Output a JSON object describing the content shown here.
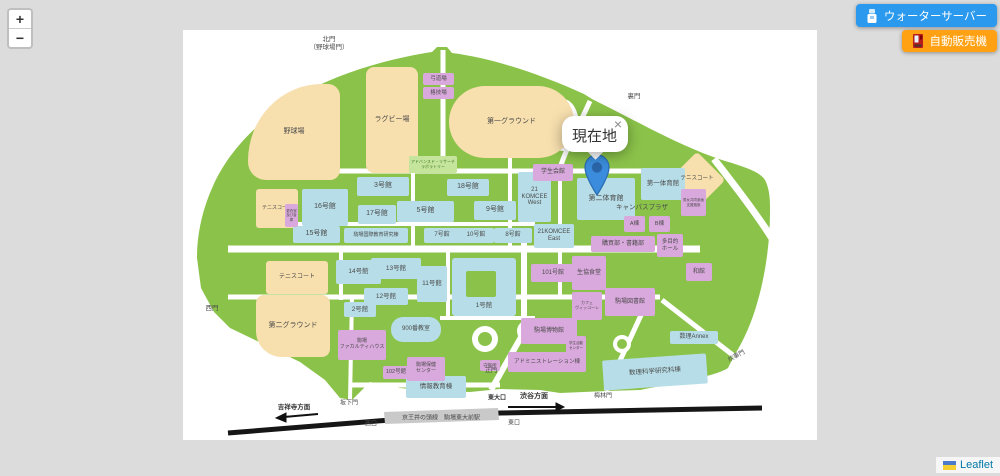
{
  "ui": {
    "zoom_in": "+",
    "zoom_out": "−",
    "buttons": {
      "water": {
        "label": "ウォーターサーバー",
        "color": "#2B99EE"
      },
      "vending": {
        "label": "自動販売機",
        "color": "#FFA113"
      }
    },
    "popup": {
      "text": "現在地",
      "close": "×"
    },
    "attribution": {
      "label": "Leaflet"
    }
  },
  "map": {
    "colors": {
      "campus_green": "#8BC34A",
      "building_blue": "#B7DEE8",
      "building_pink": "#D9A8DC",
      "field_tan": "#F7DFAE",
      "road_white": "#ffffff",
      "railway_black": "#161616",
      "marker_blue": "#3B8CDC"
    },
    "shapes": [
      {
        "label": "野球場",
        "kind": "tan",
        "x": 248,
        "y": 84,
        "w": 92,
        "h": 96,
        "br": "80% 12px 10px 18px",
        "fs": 7
      },
      {
        "label": "ラグビー場",
        "kind": "tan",
        "x": 366,
        "y": 67,
        "w": 52,
        "h": 106,
        "br": "8px",
        "fs": 7
      },
      {
        "label": "第一グラウンド",
        "kind": "tan",
        "x": 449,
        "y": 86,
        "w": 125,
        "h": 72,
        "br": "36px",
        "fs": 7
      },
      {
        "label": "",
        "kind": "tan",
        "x": 677,
        "y": 160,
        "w": 40,
        "h": 40,
        "rot": 45,
        "br": "4px"
      },
      {
        "label": "テニスコート",
        "kind": "tan",
        "x": 256,
        "y": 189,
        "w": 42,
        "h": 39,
        "fs": 5,
        "br": "3px"
      },
      {
        "label": "テニスコート",
        "kind": "tan",
        "x": 266,
        "y": 261,
        "w": 62,
        "h": 33,
        "fs": 6,
        "br": "3px"
      },
      {
        "label": "第二グラウンド",
        "kind": "tan",
        "x": 256,
        "y": 295,
        "w": 74,
        "h": 62,
        "br": "8px 8px 8px 26px",
        "fs": 7
      },
      {
        "label": "3号館",
        "kind": "blue",
        "x": 357,
        "y": 177,
        "w": 52,
        "h": 19,
        "fs": 7
      },
      {
        "label": "16号館",
        "kind": "blue",
        "x": 302,
        "y": 189,
        "w": 46,
        "h": 37,
        "fs": 7
      },
      {
        "label": "17号館",
        "kind": "blue",
        "x": 358,
        "y": 205,
        "w": 38,
        "h": 19,
        "fs": 7
      },
      {
        "label": "5号館",
        "kind": "blue",
        "x": 397,
        "y": 201,
        "w": 57,
        "h": 21,
        "fs": 7
      },
      {
        "label": "18号館",
        "kind": "blue",
        "x": 447,
        "y": 179,
        "w": 42,
        "h": 17,
        "fs": 7
      },
      {
        "label": "9号館",
        "kind": "blue",
        "x": 474,
        "y": 201,
        "w": 42,
        "h": 19,
        "fs": 7
      },
      {
        "label": "15号館",
        "kind": "blue",
        "x": 293,
        "y": 226,
        "w": 47,
        "h": 17,
        "fs": 7
      },
      {
        "label": "駒場国際教育研究棟",
        "kind": "blue",
        "x": 344,
        "y": 228,
        "w": 64,
        "h": 15,
        "fs": 5
      },
      {
        "label": "7号館",
        "kind": "blue",
        "x": 424,
        "y": 228,
        "w": 36,
        "h": 15,
        "fs": 6
      },
      {
        "label": "10号館",
        "kind": "blue",
        "x": 458,
        "y": 228,
        "w": 36,
        "h": 15,
        "fs": 6
      },
      {
        "label": "8号館",
        "kind": "blue",
        "x": 494,
        "y": 228,
        "w": 38,
        "h": 15,
        "fs": 6
      },
      {
        "label": "21\nKOMCEE\nWest",
        "kind": "blue",
        "x": 518,
        "y": 172,
        "w": 33,
        "h": 50,
        "fs": 6
      },
      {
        "label": "21KOMCEE\nEast",
        "kind": "blue",
        "x": 534,
        "y": 224,
        "w": 40,
        "h": 24,
        "fs": 6
      },
      {
        "label": "第二体育館",
        "kind": "blue",
        "x": 577,
        "y": 178,
        "w": 58,
        "h": 42,
        "fs": 7
      },
      {
        "label": "第一体育館",
        "kind": "blue",
        "x": 641,
        "y": 168,
        "w": 44,
        "h": 32,
        "fs": 6.5
      },
      {
        "label": "14号館",
        "kind": "blue",
        "x": 336,
        "y": 260,
        "w": 45,
        "h": 24,
        "fs": 6.5
      },
      {
        "label": "13号館",
        "kind": "blue",
        "x": 371,
        "y": 258,
        "w": 50,
        "h": 21,
        "fs": 6.5
      },
      {
        "label": "11号館",
        "kind": "blue",
        "x": 417,
        "y": 266,
        "w": 30,
        "h": 36,
        "fs": 6.5
      },
      {
        "label": "12号館",
        "kind": "blue",
        "x": 364,
        "y": 288,
        "w": 44,
        "h": 17,
        "fs": 6.5
      },
      {
        "label": "2号館",
        "kind": "blue",
        "x": 344,
        "y": 302,
        "w": 32,
        "h": 15,
        "fs": 6.5
      },
      {
        "label": "",
        "kind": "blue",
        "x": 452,
        "y": 258,
        "w": 64,
        "h": 58,
        "br": "3px"
      },
      {
        "label": "",
        "kind": "green",
        "x": 466,
        "y": 271,
        "w": 30,
        "h": 26
      },
      {
        "label": "900番教室",
        "kind": "blue",
        "x": 391,
        "y": 317,
        "w": 50,
        "h": 25,
        "br": "12px",
        "fs": 6
      },
      {
        "label": "情報教育棟",
        "kind": "blue",
        "x": 406,
        "y": 376,
        "w": 60,
        "h": 22,
        "fs": 6.5
      },
      {
        "label": "数理Annex",
        "kind": "blue",
        "x": 670,
        "y": 331,
        "w": 48,
        "h": 13,
        "fs": 6
      },
      {
        "label": "数理科学研究科棟",
        "kind": "blue",
        "x": 603,
        "y": 357,
        "w": 104,
        "h": 30,
        "rot": -4,
        "fs": 6.5
      },
      {
        "label": "弓道場",
        "kind": "pink",
        "x": 423,
        "y": 73,
        "w": 31,
        "h": 12,
        "fs": 5.5
      },
      {
        "label": "格技場",
        "kind": "pink",
        "x": 423,
        "y": 87,
        "w": 31,
        "h": 12,
        "fs": 5.5
      },
      {
        "label": "学生会館",
        "kind": "pink",
        "x": 533,
        "y": 164,
        "w": 40,
        "h": 17,
        "fs": 6
      },
      {
        "label": "A棟",
        "kind": "pink",
        "x": 624,
        "y": 216,
        "w": 21,
        "h": 16,
        "fs": 5.5
      },
      {
        "label": "B棟",
        "kind": "pink",
        "x": 649,
        "y": 216,
        "w": 21,
        "h": 16,
        "fs": 5.5
      },
      {
        "label": "購買部・書籍部",
        "kind": "pink",
        "x": 591,
        "y": 236,
        "w": 64,
        "h": 16,
        "fs": 6
      },
      {
        "label": "多目的\nホール",
        "kind": "pink",
        "x": 657,
        "y": 234,
        "w": 26,
        "h": 23,
        "fs": 5.5
      },
      {
        "label": "101号館",
        "kind": "pink",
        "x": 531,
        "y": 264,
        "w": 44,
        "h": 18,
        "fs": 6
      },
      {
        "label": "生協食堂",
        "kind": "pink",
        "x": 572,
        "y": 256,
        "w": 34,
        "h": 34,
        "fs": 6
      },
      {
        "label": "和館",
        "kind": "pink",
        "x": 686,
        "y": 263,
        "w": 26,
        "h": 18,
        "fs": 6
      },
      {
        "label": "駒場図書館",
        "kind": "pink",
        "x": 605,
        "y": 288,
        "w": 50,
        "h": 28,
        "fs": 6
      },
      {
        "label": "カフェ\nヴィッコーレ",
        "kind": "pink",
        "x": 572,
        "y": 292,
        "w": 30,
        "h": 28,
        "fs": 4
      },
      {
        "label": "駒場博物館",
        "kind": "pink",
        "x": 521,
        "y": 318,
        "w": 56,
        "h": 26,
        "fs": 6
      },
      {
        "label": "アドミニストレーション棟",
        "kind": "pink",
        "x": 508,
        "y": 352,
        "w": 78,
        "h": 20,
        "fs": 5.5
      },
      {
        "label": "学生活動\nセンター",
        "kind": "pink",
        "x": 566,
        "y": 336,
        "w": 20,
        "h": 19,
        "fs": 3.5
      },
      {
        "label": "駒場\nファカルティハウス",
        "kind": "pink",
        "x": 338,
        "y": 330,
        "w": 48,
        "h": 30,
        "fs": 5
      },
      {
        "label": "102号館",
        "kind": "pink",
        "x": 383,
        "y": 366,
        "w": 26,
        "h": 13,
        "fs": 5.5
      },
      {
        "label": "駒場保健\nセンター",
        "kind": "pink",
        "x": 407,
        "y": 357,
        "w": 38,
        "h": 24,
        "fs": 5
      },
      {
        "label": "守衛所",
        "kind": "pink",
        "x": 480,
        "y": 360,
        "w": 20,
        "h": 11,
        "fs": 4.5
      },
      {
        "label": "更衣室\n及び倉庫",
        "kind": "pink",
        "x": 285,
        "y": 204,
        "w": 13,
        "h": 23,
        "fs": 3.5
      },
      {
        "label": "男女共同参画\n支援施設",
        "kind": "pink",
        "x": 681,
        "y": 189,
        "w": 25,
        "h": 27,
        "fs": 3.5
      },
      {
        "label": "アドバンスド・リサーチ\nラボラトリー",
        "kind": "greenbox",
        "x": 409,
        "y": 156,
        "w": 48,
        "h": 17,
        "fs": 4
      }
    ],
    "texts": [
      {
        "label": "北門\n（野球場門）",
        "x": 329,
        "y": 44,
        "fs": 6.5
      },
      {
        "label": "裏門",
        "x": 634,
        "y": 97,
        "fs": 6.5
      },
      {
        "label": "西門",
        "x": 212,
        "y": 309,
        "fs": 6.5
      },
      {
        "label": "坂下門",
        "x": 349,
        "y": 404,
        "fs": 6
      },
      {
        "label": "正門",
        "x": 491,
        "y": 372,
        "fs": 6
      },
      {
        "label": "東大口",
        "x": 497,
        "y": 399,
        "fs": 6,
        "bold": true
      },
      {
        "label": "渋谷方面",
        "x": 534,
        "y": 397,
        "fs": 7,
        "bold": true
      },
      {
        "label": "東口",
        "x": 514,
        "y": 424,
        "fs": 6
      },
      {
        "label": "西口",
        "x": 371,
        "y": 425,
        "fs": 6
      },
      {
        "label": "京王井の頭線　駒場東大前駅",
        "x": 441,
        "y": 419,
        "fs": 6
      },
      {
        "label": "吉祥寺方面",
        "x": 294,
        "y": 408,
        "fs": 6.5,
        "bold": true
      },
      {
        "label": "梅林門",
        "x": 603,
        "y": 397,
        "fs": 6
      },
      {
        "label": "炊事門",
        "x": 737,
        "y": 357,
        "fs": 6,
        "rot": -28
      },
      {
        "label": "テニスコート",
        "x": 697,
        "y": 179,
        "fs": 5.5
      },
      {
        "label": "1号館",
        "x": 484,
        "y": 306,
        "fs": 6.5
      },
      {
        "label": "キャンパスプラザ",
        "x": 642,
        "y": 208,
        "fs": 6.5
      }
    ]
  }
}
